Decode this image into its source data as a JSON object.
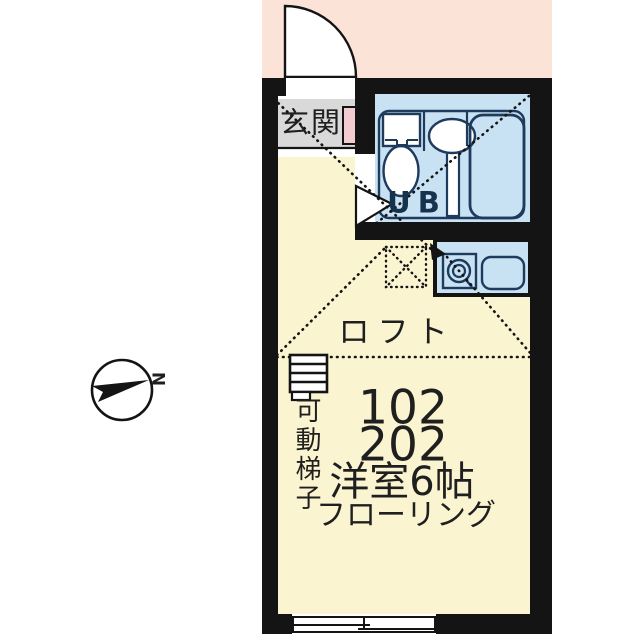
{
  "compass": {
    "north_label": "N"
  },
  "labels": {
    "entrance": "玄関",
    "unit_bath": "UB",
    "loft": "ロフト",
    "movable_ladder": "可動梯子"
  },
  "room_info": {
    "unit_numbers": [
      "102",
      "202"
    ],
    "room_type_size": "洋室6帖",
    "flooring": "フローリング"
  },
  "colors": {
    "exterior_band": "#fbe3d8",
    "wall": "#141414",
    "room_floor": "#faf5d0",
    "entrance_floor": "#d9d9d9",
    "wet_area_fill": "#c9e2f3",
    "fixture_line": "#1e3a5c",
    "shoe_cabinet": "#f3ccd2"
  }
}
